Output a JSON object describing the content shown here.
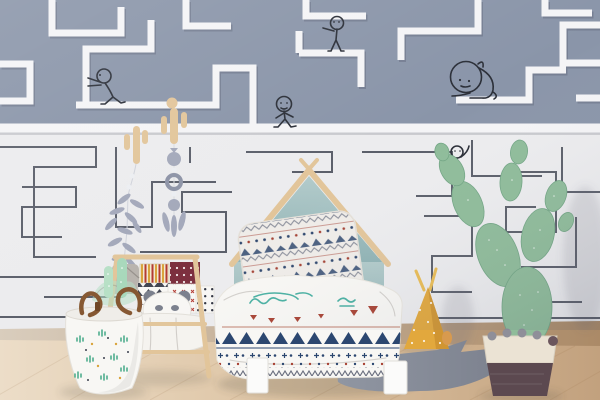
{
  "scene": {
    "description": "Photograph of a child's bedroom with maze wallpaper: slate-blue upper band with thick white maze paths and five doodled stick figures, white lower band with thin dark maze lines, a house-frame bed with patterned pillow and aztec duvet, a wooden sling book rack, a cactus-print laundry basket, hanging wooden cactus hooks with grey felt garlands, a yellow dotted teepee cushion, a grey fish-shaped rug and a paper prickly-pear cactus in a two-tone pot on a wooden floor.",
    "wall_doodles": [
      {
        "name": "pushing-figure",
        "pose": "leaning against a maze wall"
      },
      {
        "name": "walking-figure",
        "pose": "walking on the maze boundary line"
      },
      {
        "name": "standing-figure",
        "pose": "standing on an upper maze path"
      },
      {
        "name": "crawling-figure",
        "pose": "large head, crawling on a maze path"
      },
      {
        "name": "waving-figure",
        "pose": "small figure waving inside lower maze"
      }
    ],
    "doodle_count": 5
  },
  "wallpaper": {
    "top_band": {
      "style": "thick white maze paths on slate blue"
    },
    "bottom_band": {
      "style": "thin dark maze lines on off-white"
    }
  },
  "furniture": {
    "bed": {
      "headboard": "house / gable frame",
      "panel": "muted teal",
      "legs": "white"
    },
    "bedding": {
      "pillow": "aztec triangles and zigzags",
      "duvet": "white with teal scribbles, red triangles, navy triangle and dot bands"
    },
    "book_rack": {
      "type": "wooden sling shelf",
      "contents": [
        "grey pouch",
        "striped book",
        "maroon dotted book",
        "black-and-white pattern books",
        "panda cushion"
      ]
    },
    "basket": {
      "print": "mini cacti",
      "handles": "brown leather",
      "contents": "mint cactus plush and blanket"
    },
    "teepee_cushion": {
      "color_name": "mustard",
      "pattern": "white dots"
    },
    "rug": {
      "shape": "fish",
      "color_name": "grey"
    },
    "plant": {
      "type": "prickly pear cactus",
      "pot": "cream band with pompoms over plum base"
    },
    "wall_hooks": [
      "wooden cactus hook with felt leaf garland",
      "wooden cactus hook with pompom and ring garland"
    ]
  },
  "colors": {
    "wall_top_bg": "#8a95a9",
    "wall_top_path": "#f4f4f6",
    "wall_bottom_bg": "#ececee",
    "wall_line": "#3b3f4d",
    "doodle": "#2b2f38",
    "white_soft": "#f8f7f4",
    "navy": "#2c4770",
    "red": "#a84233",
    "maroon": "#7c2f3e",
    "mustard": "#e2a83d",
    "mustard_dark": "#cd9230",
    "rug": "#878c98",
    "cactus": "#8fbc9a",
    "cactus_dark": "#73a685",
    "pot_cream": "#ebe3d4",
    "pot_plum": "#5c4950",
    "leather": "#855732",
    "mint": "#b7e0c6",
    "felt": "#a3a8ba",
    "felt_dark": "#8d93a6",
    "wood": "#e2c59a",
    "wood_dark": "#c9a571",
    "bed_teal": "#a9c3c5",
    "bed_teal_dark": "#8badb3",
    "gray_pouch": "#b9b4ae",
    "floor_left": "#ecddc8",
    "floor_right": "#c2a17e",
    "stripe_yellow": "#d9a43c"
  }
}
